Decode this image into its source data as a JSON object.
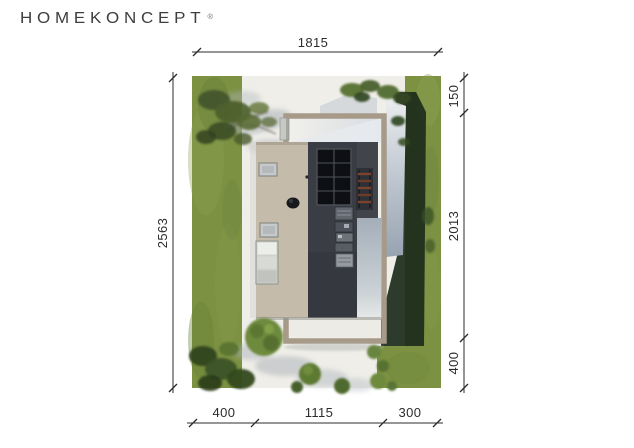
{
  "logo": {
    "text": "HOMEKONCEPT",
    "registered": "®"
  },
  "site_plan": {
    "dimensions": {
      "top": {
        "label": "1815"
      },
      "left": {
        "label": "2563"
      },
      "right": {
        "segments": [
          {
            "label": "150"
          },
          {
            "label": "2013"
          },
          {
            "label": "400"
          }
        ]
      },
      "bottom": {
        "segments": [
          {
            "label": "400"
          },
          {
            "label": "1115"
          },
          {
            "label": "300"
          }
        ]
      }
    },
    "colors": {
      "grass": "#7c9142",
      "concrete": "#efeee9",
      "roof_light": "#c4bbaa",
      "roof_dark": "#3a3d44",
      "pergola_frame": "#a79a89",
      "glass": "#9aa7b5",
      "shadow_green": "#1c2b1b",
      "dimension": "#2c2c2c"
    }
  }
}
